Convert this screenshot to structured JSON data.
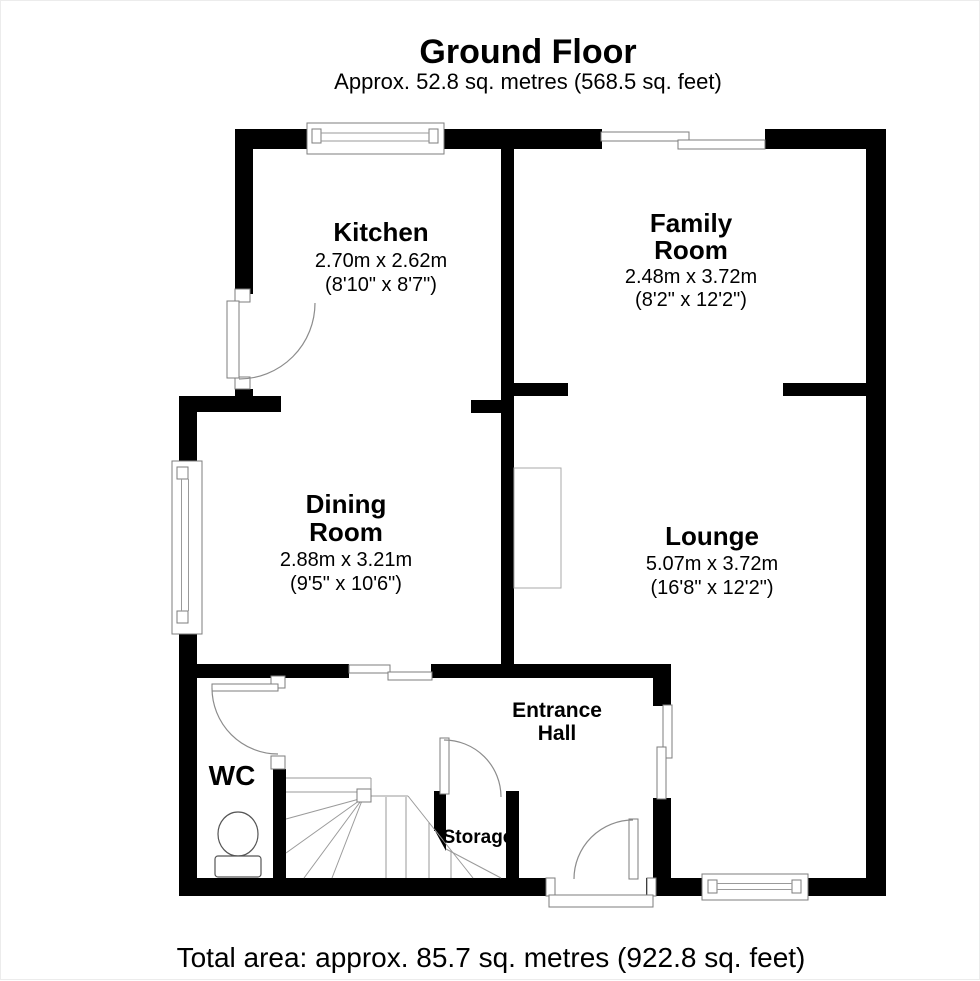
{
  "header": {
    "title": "Ground Floor",
    "subtitle": "Approx. 52.8 sq. metres (568.5 sq. feet)"
  },
  "footer": {
    "total_area": "Total area: approx. 85.7 sq. metres (922.8 sq. feet)"
  },
  "rooms": {
    "kitchen": {
      "name": "Kitchen",
      "metric": "2.70m x 2.62m",
      "imperial": "(8'10\" x 8'7\")"
    },
    "family_room": {
      "name_line1": "Family",
      "name_line2": "Room",
      "metric": "2.48m x 3.72m",
      "imperial": "(8'2\" x 12'2\")"
    },
    "dining_room": {
      "name_line1": "Dining",
      "name_line2": "Room",
      "metric": "2.88m x 3.21m",
      "imperial": "(9'5\" x 10'6\")"
    },
    "lounge": {
      "name": "Lounge",
      "metric": "5.07m x 3.72m",
      "imperial": "(16'8\" x 12'2\")"
    },
    "entrance_hall": {
      "name_line1": "Entrance",
      "name_line2": "Hall"
    },
    "wc": {
      "name": "WC"
    },
    "storage": {
      "name": "Storage"
    }
  },
  "colors": {
    "wall": "#000000",
    "thin_line": "#8c8c8c",
    "background": "#ffffff"
  }
}
